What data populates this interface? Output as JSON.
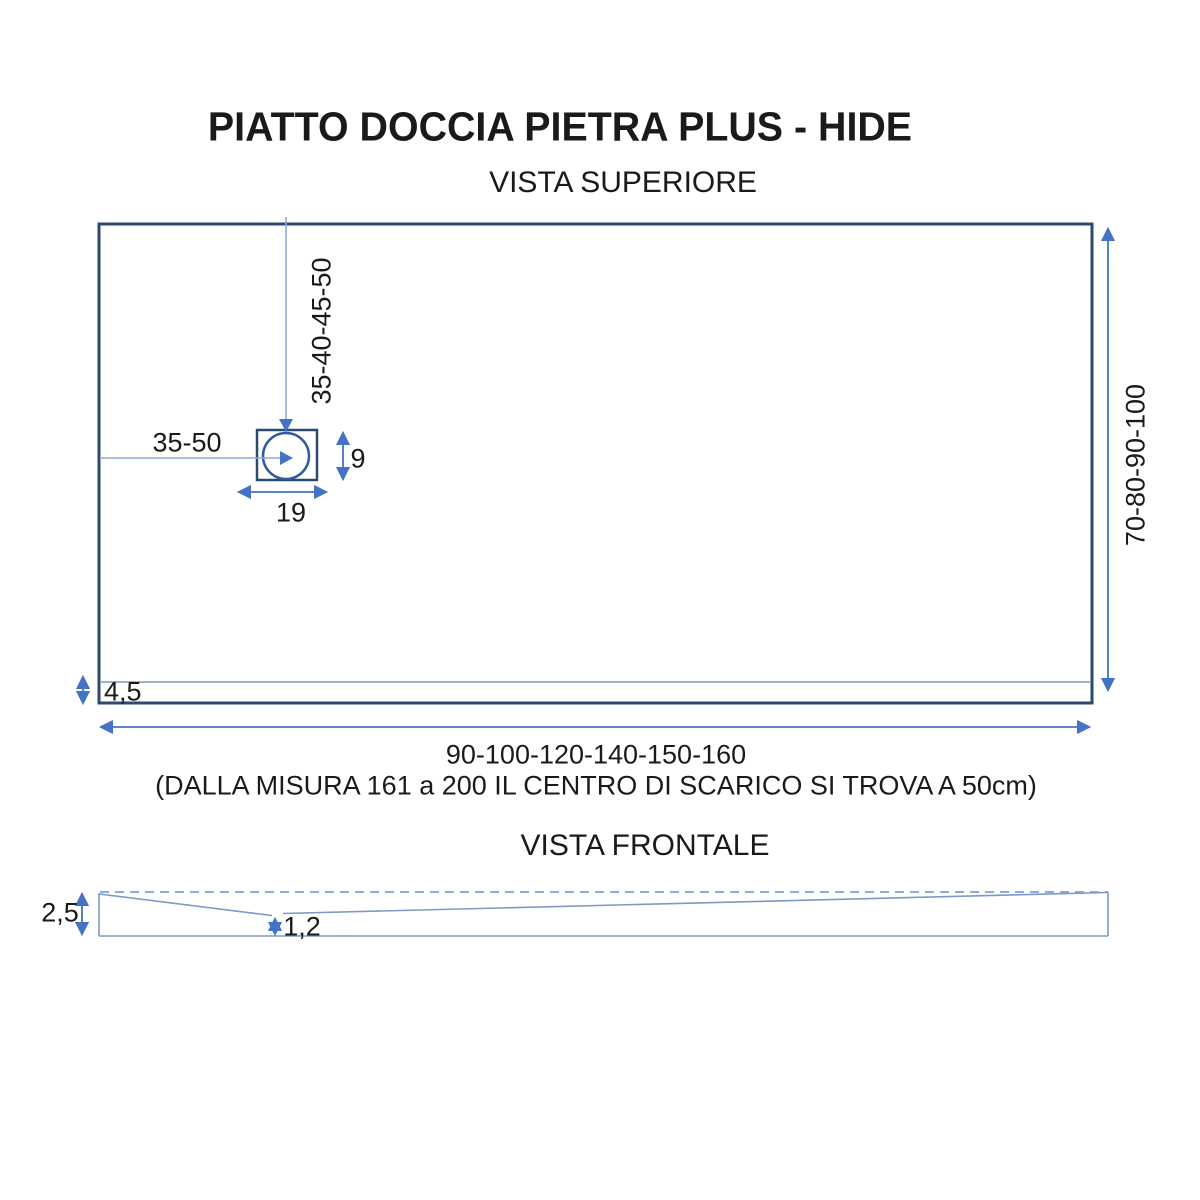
{
  "title": "PIATTO DOCCIA PIETRA PLUS - HIDE",
  "top_view": {
    "heading": "VISTA SUPERIORE",
    "drain_vertical_offset": "35-40-45-50",
    "drain_horizontal_offset": "35-50",
    "drain_height": "9",
    "drain_width": "19",
    "tray_depth_options": "70-80-90-100",
    "edge_band_height": "4,5",
    "tray_width_options": "90-100-120-140-150-160",
    "note": "(DALLA MISURA 161 a 200 IL CENTRO DI SCARICO SI TROVA A 50cm)"
  },
  "front_view": {
    "heading": "VISTA FRONTALE",
    "edge_thickness": "2,5",
    "drain_point_thickness": "1,2"
  },
  "colors": {
    "outline": "#2c4a70",
    "drain_circle": "#2f5c9e",
    "dimension": "#4472c4",
    "leader": "#8faadc",
    "inner_line": "#8297b6",
    "front_line": "#7e99c4",
    "dashed_line": "#7ba1dc",
    "text": "#1a1a1a",
    "background": "#ffffff"
  }
}
